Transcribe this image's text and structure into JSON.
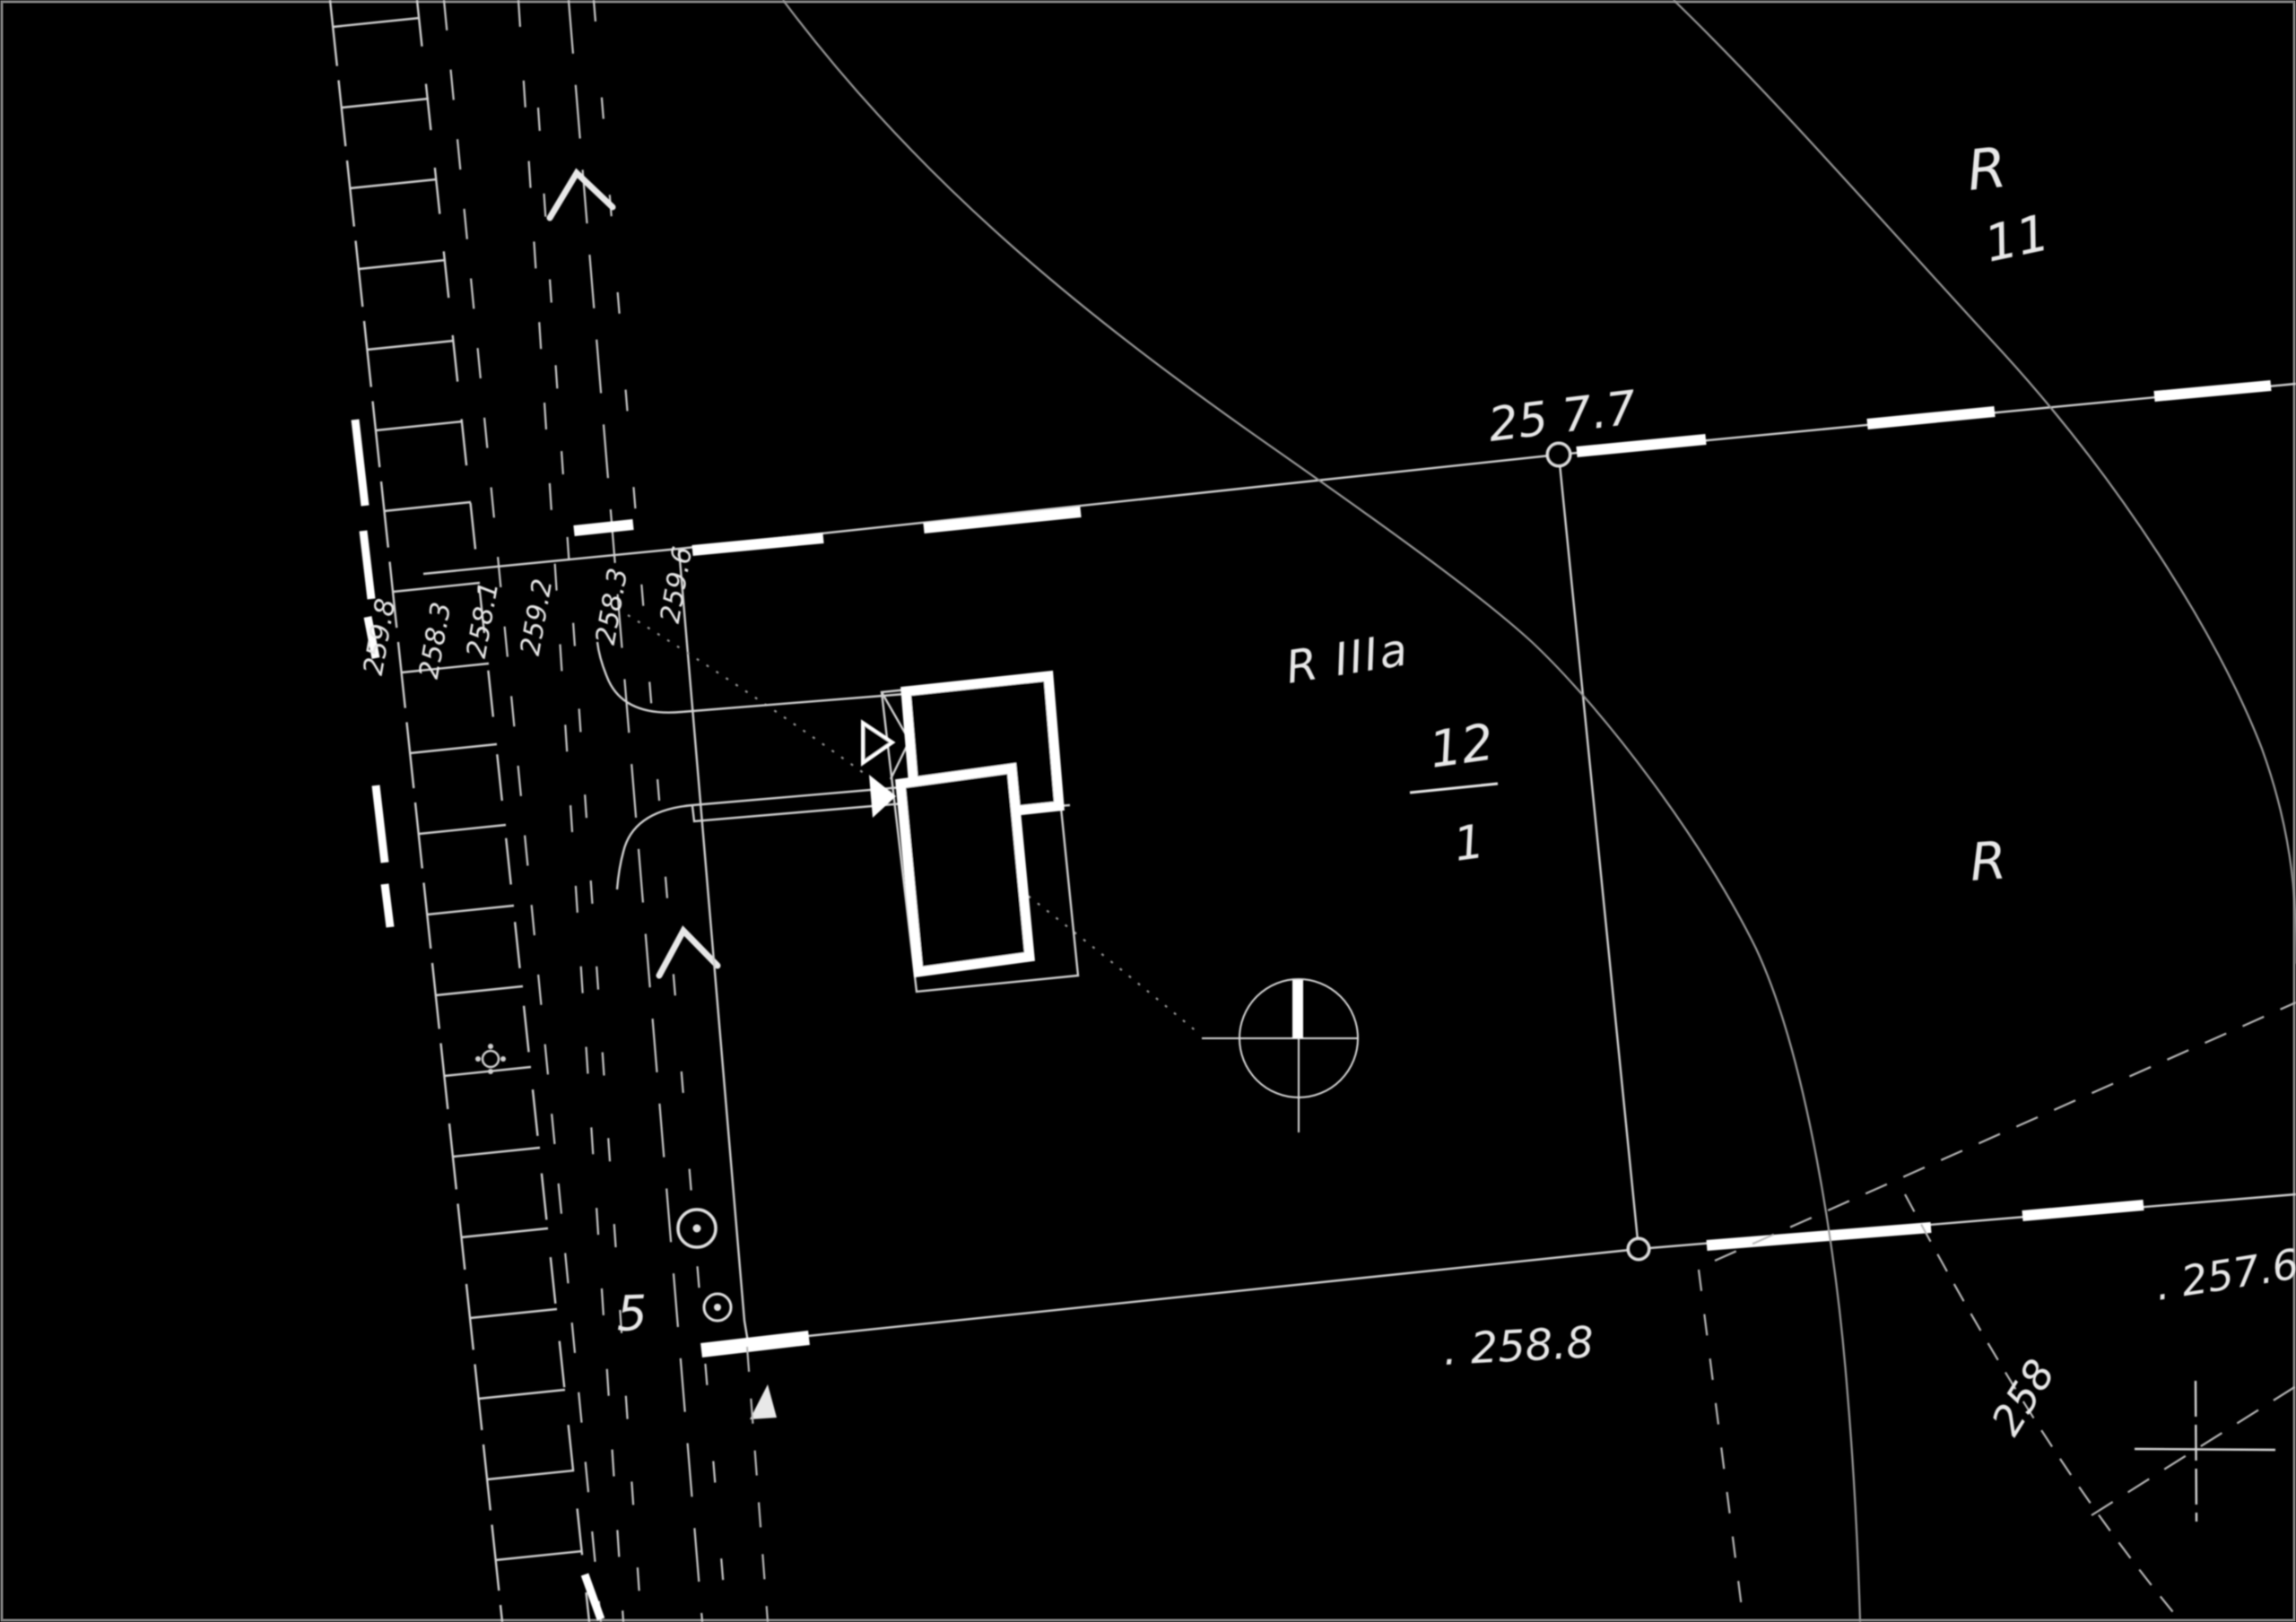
{
  "map": {
    "type": "scanned cadastral site plan, white linework on black (inverted photostat)",
    "labels": {
      "region_r_top": "R",
      "parcel_11": "11",
      "boundary_elev_2577": "25 7.7",
      "soil_class": "R IIIa",
      "parcel_12_numerator": "12",
      "parcel_12_denominator": "1",
      "region_r_right": "R",
      "spot_elev_2588": ". 258.8",
      "spot_elev_2576": ". 257.6",
      "contour_label_258": "258",
      "road_number_5": "5",
      "road_elevations": [
        "259.8",
        "258.3",
        "258.1",
        "259.2",
        "258.3",
        "259.6"
      ]
    },
    "symbols": {
      "survey_point": "circle-with-crosshair-and-solid-north-bar",
      "benchmark_large": "circle-with-center-dot",
      "benchmark_small": "circle-with-center-dot",
      "rosette": "small-petal-circle",
      "grid_cross": "coordinate-grid-cross",
      "road_arrows": "two chevron direction arrows on road centerline",
      "buildings": "two thick-outline building footprints with entrance triangles"
    },
    "colors": {
      "background": "#000000",
      "linework": "#d0d0d0",
      "bold_dashes": "#ffffff",
      "contours": "#989898",
      "text": "#e8e8e8"
    }
  }
}
